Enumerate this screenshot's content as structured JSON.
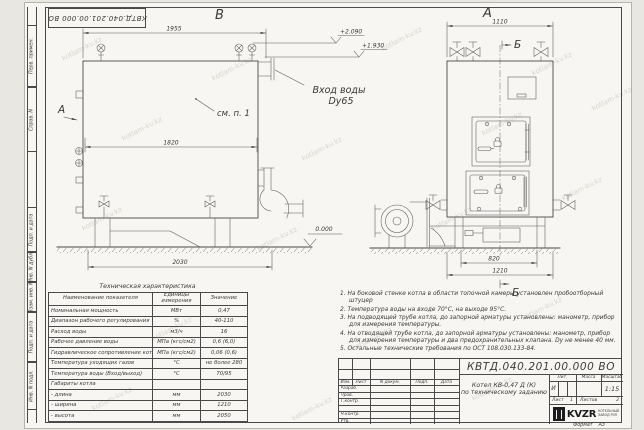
{
  "watermark": "kotlam-kv.kz",
  "stamp": {
    "doc_number_rotated": "КВТД.040.201.00.000 ВО"
  },
  "frame": {
    "labels": [
      "Перв. примен.",
      "Справ. N",
      "Подп. и дата",
      "Инв. N дубл.",
      "Взам. инв. N",
      "Подп. и дата",
      "Инв. N подл."
    ]
  },
  "views": {
    "b": {
      "label": "В",
      "dim_top": "1955",
      "dim_width_inner": "1820",
      "dim_base": "2030",
      "view_arrow": "А",
      "callout": "см. п. 1",
      "elevation_zero": "0.000"
    },
    "a": {
      "label": "А",
      "dim_top": "1110",
      "dim_base_inner": "820",
      "dim_base": "1210",
      "section_top": "Б",
      "section_bottom": "Б"
    },
    "annotations": {
      "elev_high": "+2.090",
      "elev_mid": "+1.930",
      "inlet_line1": "Вход воды",
      "inlet_line2": "Dy65"
    }
  },
  "spec_table": {
    "title": "Техническая характеристика",
    "headers": [
      "Наименование показателя",
      "Единицы измерения",
      "Значение"
    ],
    "rows": [
      [
        "Номинальная мощность",
        "МВт",
        "0,47"
      ],
      [
        "Диапазон рабочего регулирования",
        "%",
        "40-110"
      ],
      [
        "Расход воды",
        "м3/ч",
        "16"
      ],
      [
        "Рабочее давление воды",
        "МПа (кгс/см2)",
        "0,6 (6,0)"
      ],
      [
        "Гидравлическое сопротивление котла",
        "МПа (кгс/см2)",
        "0,06 (0,6)"
      ],
      [
        "Температура уходящих газов",
        "°С",
        "не более 280"
      ],
      [
        "Температура воды (Вход/выход)",
        "°С",
        "70/95"
      ],
      [
        "Габариты котла",
        "",
        ""
      ],
      [
        "  - длина",
        "мм",
        "2030"
      ],
      [
        "  - ширина",
        "мм",
        "1210"
      ],
      [
        "  - высота",
        "мм",
        "2050"
      ]
    ]
  },
  "notes": [
    "1.  На боковой стенке котла в области топочной камеры установлен пробоотборный штуцер",
    "2.  Температура воды на входе 70°С, на выходе 95°С.",
    "3.  На подводящей трубе котла, до запорной арматуры установлены: манометр, прибор для измерения температуры.",
    "4.  На отводящей трубе котла, до запорной арматуры установлены: манометр, прибор для измерения температуры и два предохранительных клапана. Dу не менее 40 мм.",
    "5.  Остальные технические требования по ОСТ 108.030.133-84."
  ],
  "title_block": {
    "doc_number": "КВТД.040.201.00.000 ВО",
    "rev_header": [
      "Изм.",
      "Лист",
      "N докум.",
      "Подп.",
      "Дата"
    ],
    "roles": [
      "Разраб.",
      "Пров.",
      "Т.контр.",
      "",
      "Н.контр.",
      "Утв."
    ],
    "title_line1": "Котел КВ-0,47 Д (К)",
    "title_line2": "по техническому заданию",
    "lit_header": "Лит.",
    "mass_header": "Масса",
    "scale_header": "Масштаб",
    "lit_value": "И",
    "scale_value": "1:15",
    "sheet_label": "Лист",
    "sheet_value": "1",
    "sheets_label": "Листов",
    "sheets_value": "2",
    "logo_text": "KVZR",
    "logo_caption1": "КОТЕЛЬНЫЙ",
    "logo_caption2": "ЗАВОД РЭП",
    "format_label": "Формат",
    "format_value": "А3"
  }
}
